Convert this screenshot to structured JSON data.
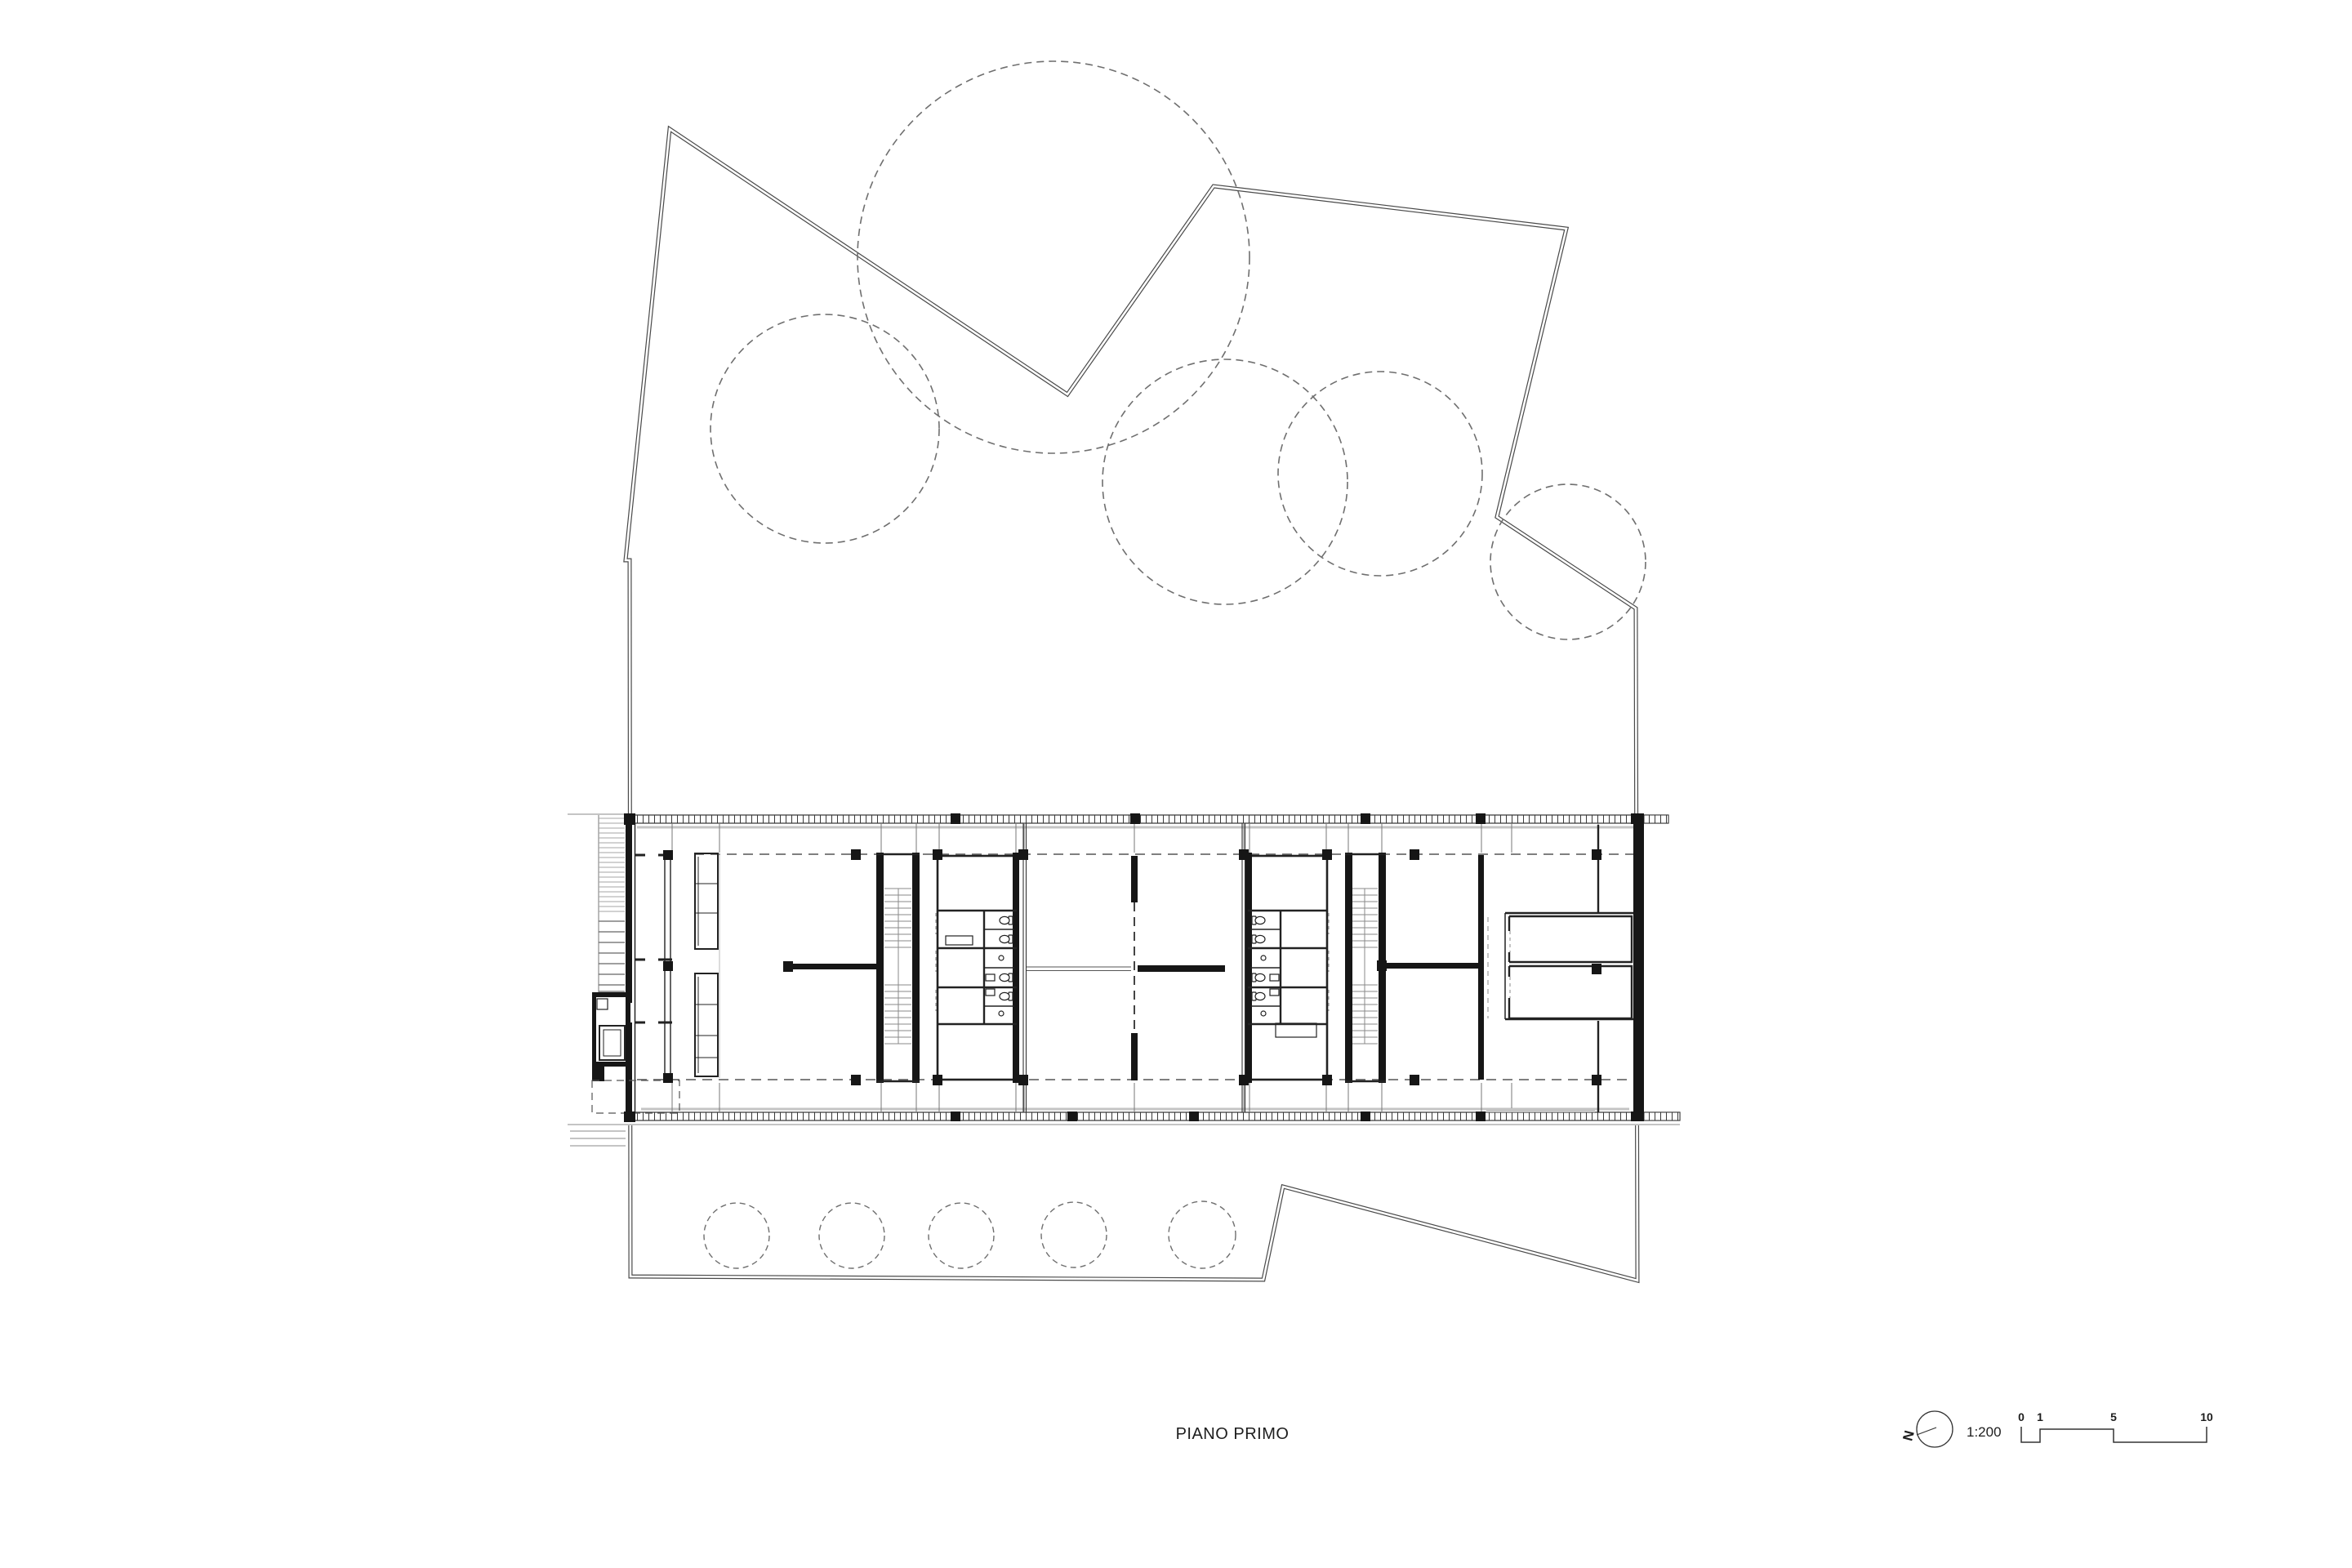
{
  "title": {
    "text": "PIANO PRIMO"
  },
  "legend": {
    "north_label": "N",
    "scale_ratio": "1:200",
    "scale_ticks": [
      "0",
      "1",
      "5",
      "10"
    ]
  },
  "icons": {
    "north_arrow": "north-arrow-icon",
    "scale_bar": "scale-bar-icon"
  },
  "colors": {
    "background": "#ffffff",
    "ink": "#1d1d1d",
    "wall": "#161616",
    "site_boundary": "#4a4a4a",
    "tree": "#6f6f6f",
    "slab_gray": "#c4c4c4",
    "tread_gray": "#8a8a8a"
  }
}
